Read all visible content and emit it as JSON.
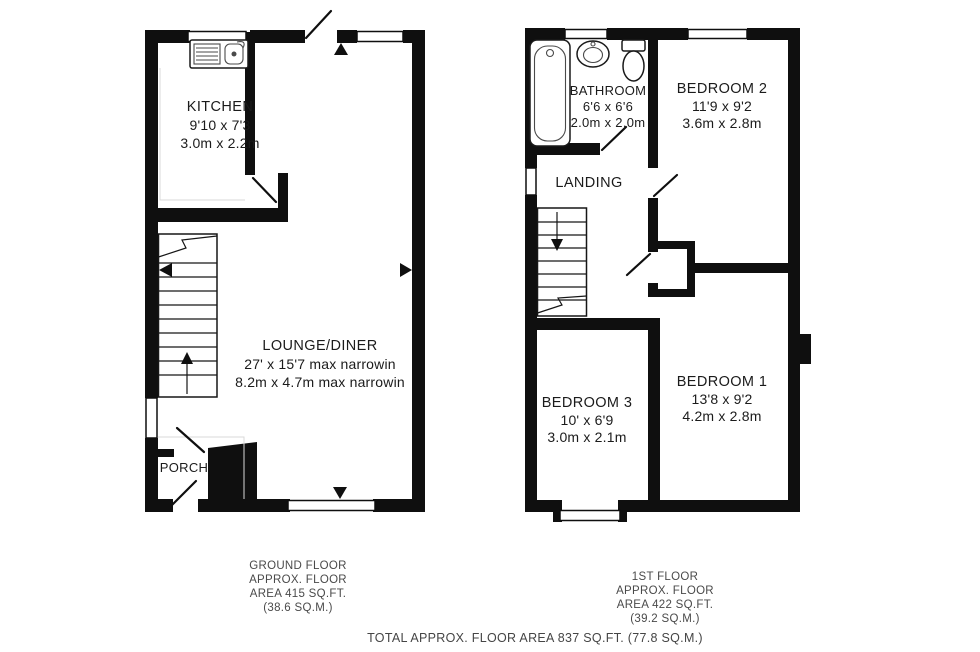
{
  "ground_floor": {
    "rooms": {
      "kitchen": {
        "name": "KITCHEN",
        "imperial": "9'10 x 7'3",
        "metric": "3.0m x 2.2m"
      },
      "lounge": {
        "name": "LOUNGE/DINER",
        "imperial": "27' x 15'7 max narrowin",
        "metric": "8.2m x 4.7m max narrowin"
      },
      "porch": {
        "name": "PORCH"
      }
    },
    "footer": {
      "line1": "GROUND FLOOR",
      "line2": "APPROX. FLOOR",
      "line3": "AREA 415 SQ.FT.",
      "line4": "(38.6 SQ.M.)"
    }
  },
  "first_floor": {
    "rooms": {
      "bathroom": {
        "name": "BATHROOM",
        "imperial": "6'6 x 6'6",
        "metric": "2.0m x 2.0m"
      },
      "bedroom2": {
        "name": "BEDROOM 2",
        "imperial": "11'9 x 9'2",
        "metric": "3.6m x 2.8m"
      },
      "landing": {
        "name": "LANDING"
      },
      "bedroom3": {
        "name": "BEDROOM 3",
        "imperial": "10' x 6'9",
        "metric": "3.0m x 2.1m"
      },
      "bedroom1": {
        "name": "BEDROOM 1",
        "imperial": "13'8 x 9'2",
        "metric": "4.2m x 2.8m"
      }
    },
    "footer": {
      "line1": "1ST FLOOR",
      "line2": "APPROX. FLOOR",
      "line3": "AREA 422 SQ.FT.",
      "line4": "(39.2 SQ.M.)"
    }
  },
  "total_line": "TOTAL APPROX. FLOOR AREA 837 SQ.FT. (77.8 SQ.M.)",
  "colors": {
    "wall": "#0f0f0f",
    "text": "#1b1b1b",
    "footer_text": "#4a4a4a",
    "background": "#ffffff"
  }
}
